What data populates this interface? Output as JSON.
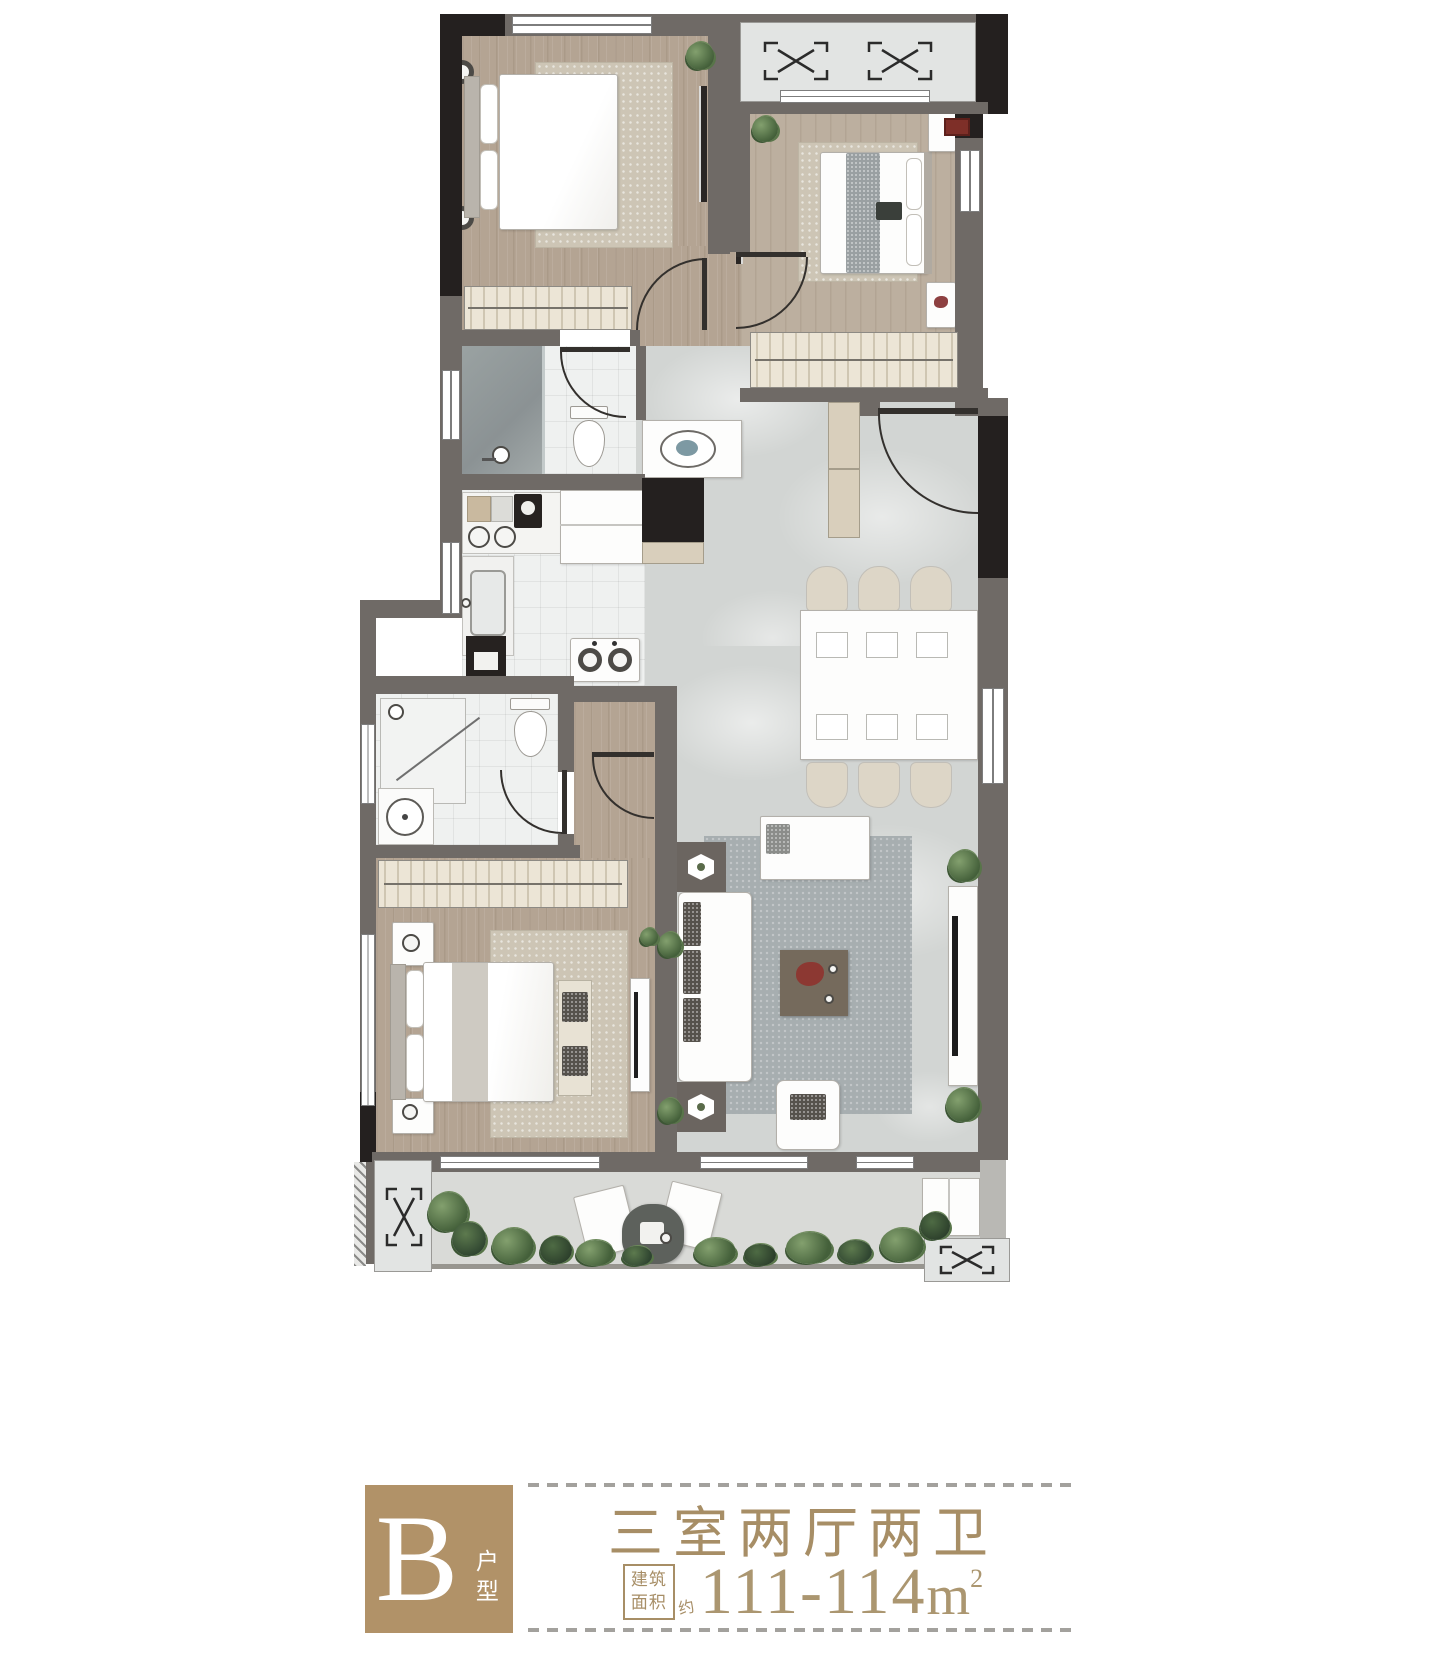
{
  "legend": {
    "unit_letter": "B",
    "unit_type_label": "户型",
    "layout_title": "三室两厅两卫",
    "area_label_line1": "建筑",
    "area_label_line2": "面积",
    "area_approx": "约",
    "area_value": "111-114",
    "area_unit": "m",
    "area_unit_sup": "2"
  },
  "palette": {
    "brand_tan": "#b19268",
    "text_tan": "#a78e66",
    "dash_gray": "#a3a19d",
    "wall_gray": "#6f6a66",
    "wall_black": "#24201f",
    "wood_floor": "#b4a493",
    "marble_floor": "#d2d5d3",
    "tile_floor": "#eff1f0",
    "terrace_floor": "#d9dad7",
    "plant_green": "#44603a"
  }
}
